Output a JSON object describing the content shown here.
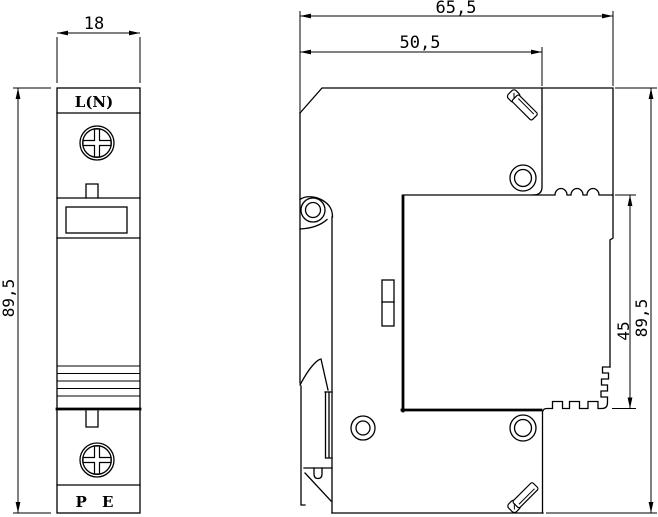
{
  "drawing": {
    "type": "technical-dimension-drawing",
    "subject": "DIN-rail surge protector module, front and side views",
    "colors": {
      "line": "#000000",
      "background": "#ffffff"
    },
    "front_view": {
      "top_terminal_label": "L(N)",
      "bottom_terminal_label": "P E"
    },
    "dimensions": {
      "front_width_mm": "18",
      "front_height_mm": "89,5",
      "side_total_depth_mm": "65,5",
      "side_base_depth_mm": "50,5",
      "side_module_height_mm": "45",
      "side_total_height_mm": "89,5"
    }
  }
}
